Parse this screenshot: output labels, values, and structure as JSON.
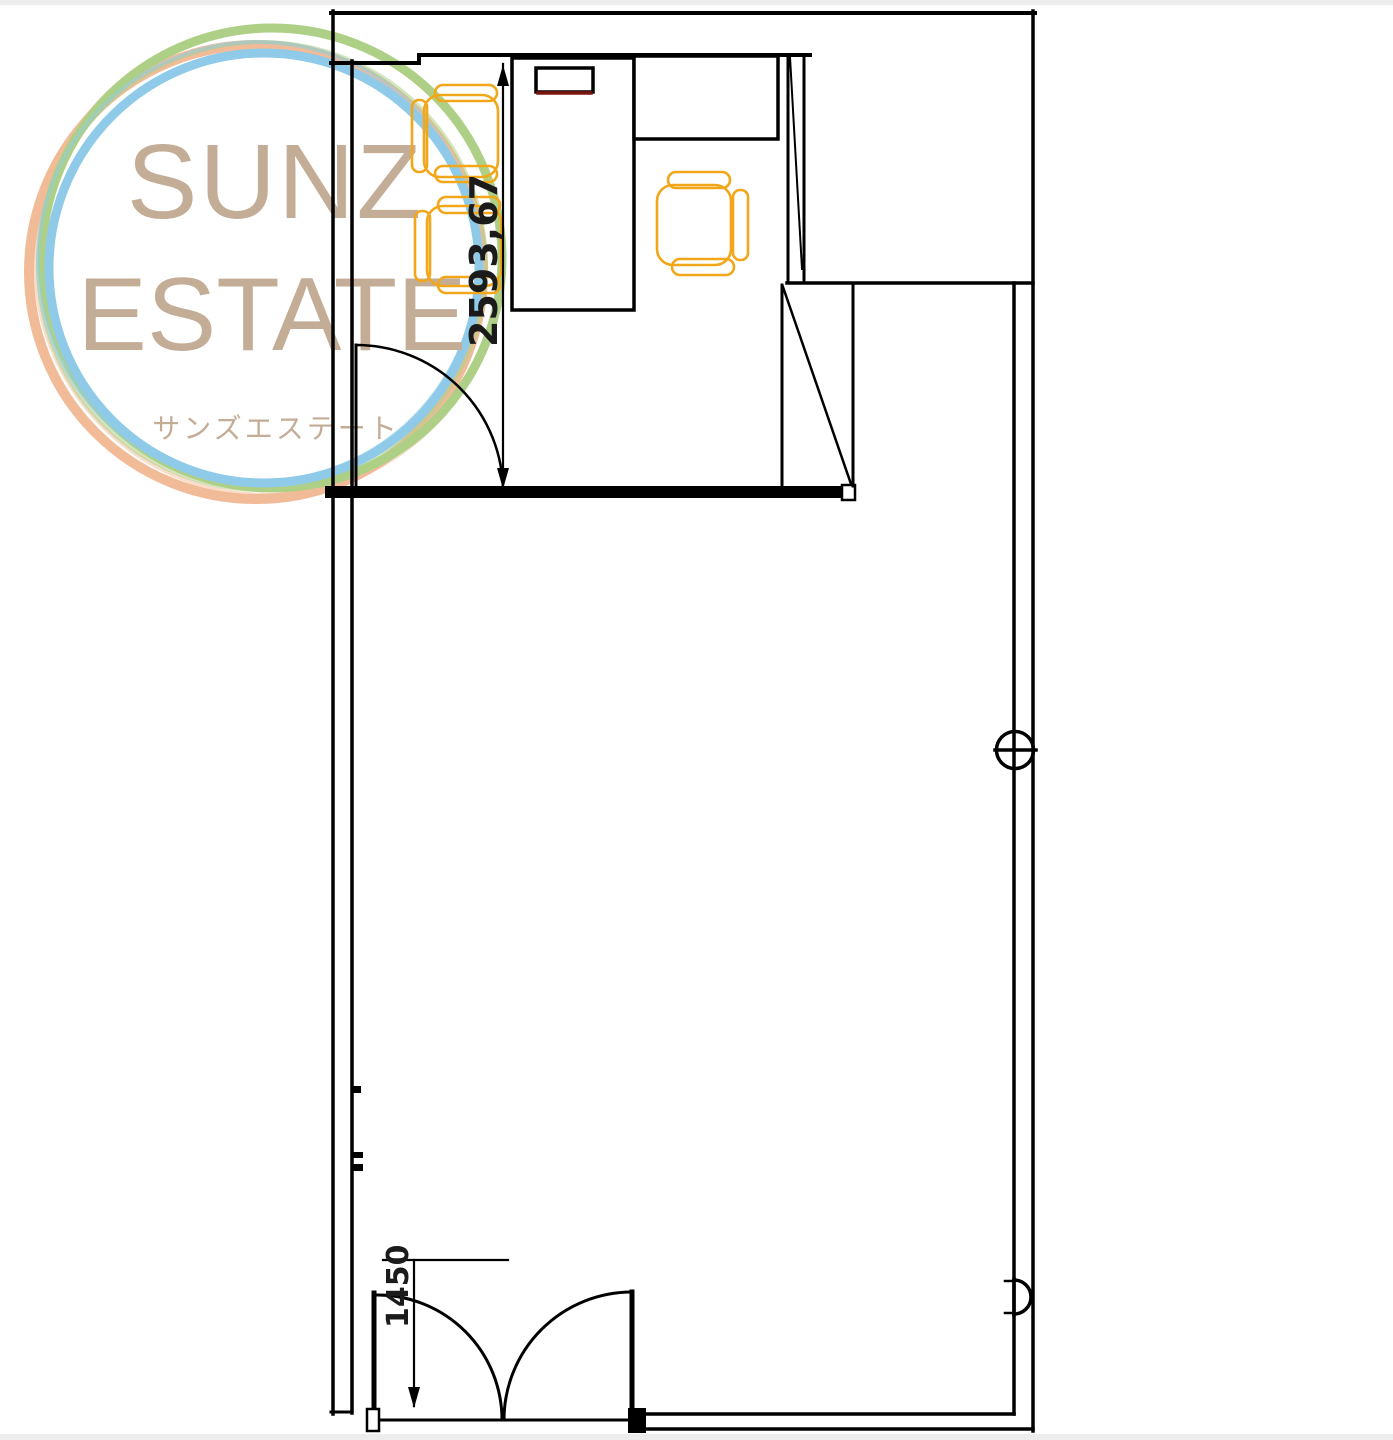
{
  "watermark": {
    "line1": "SUNZ",
    "line2": "ESTATE",
    "line3": "サンズエステート",
    "text_color": "#c4ad97",
    "rings": {
      "green": "#aed086",
      "orange": "#f2bb97",
      "blue": "#8fcbe8"
    }
  },
  "plan": {
    "ink": "#000000",
    "chair_color": "#f2a71b",
    "monitor_accent": "#7c1411",
    "dim_text_color": "#1b1b1b",
    "dims": {
      "room_depth": "2593,67",
      "entrance": "1450"
    }
  }
}
